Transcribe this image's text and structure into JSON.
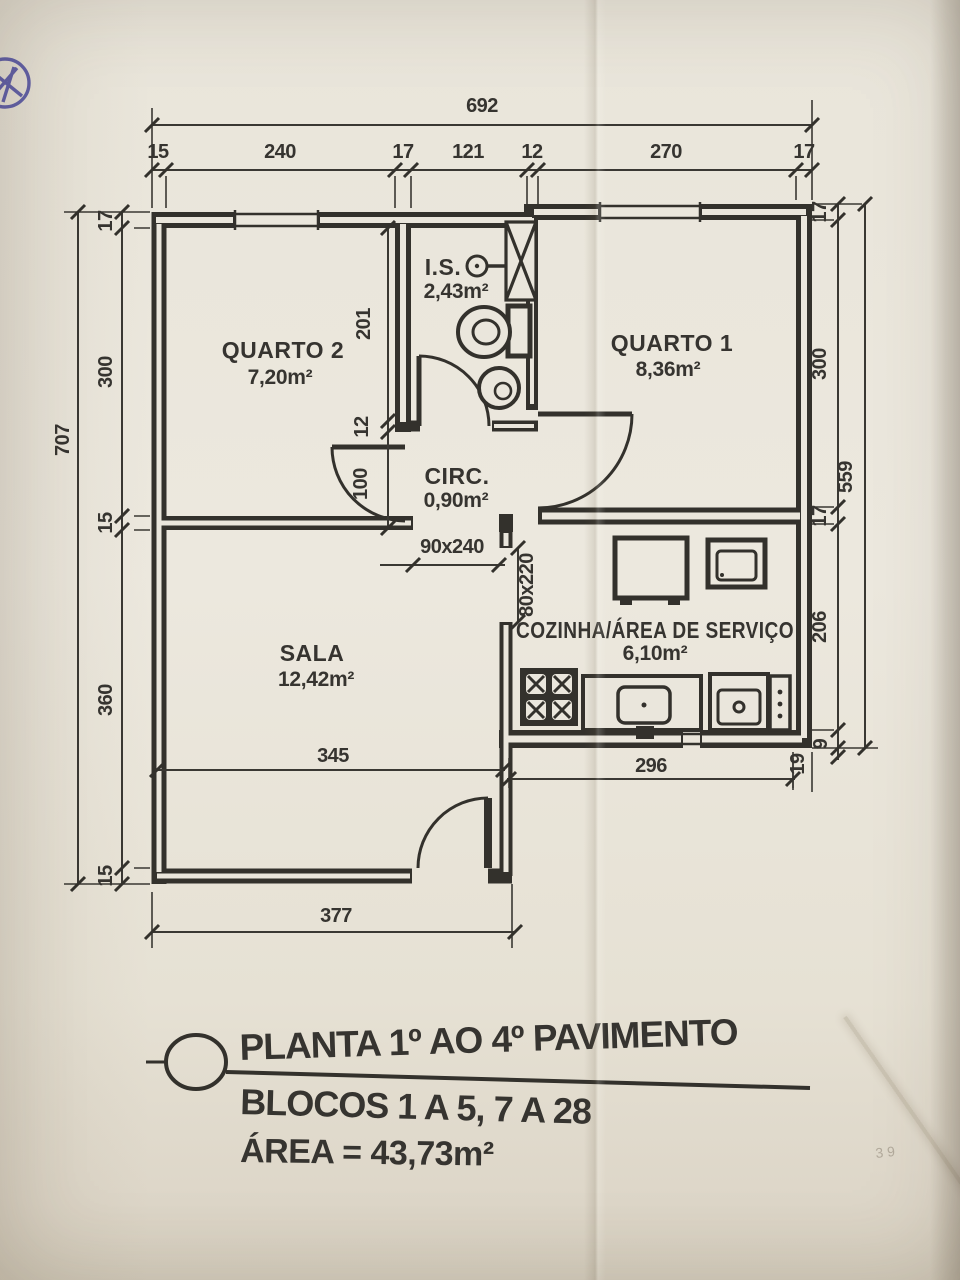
{
  "palette": {
    "paper": "#eae6dc",
    "ink": "#33312c",
    "stamp_blue": "#41419a"
  },
  "rooms": [
    {
      "name": "QUARTO 2",
      "area": "7,20m²"
    },
    {
      "name": "I.S.",
      "area": "2,43m²"
    },
    {
      "name": "QUARTO 1",
      "area": "8,36m²"
    },
    {
      "name": "CIRC.",
      "area": "0,90m²"
    },
    {
      "name": "SALA",
      "area": "12,42m²"
    },
    {
      "name": "COZINHA/ÁREA DE SERVIÇO",
      "area": "6,10m²"
    }
  ],
  "dimensions": {
    "top": {
      "total": "692",
      "segments": [
        "15",
        "240",
        "17",
        "121",
        "12",
        "270",
        "17"
      ]
    },
    "left": {
      "total": "707",
      "segments": [
        "17",
        "300",
        "15",
        "360",
        "15"
      ]
    },
    "right": {
      "total": "559",
      "segments": [
        "17",
        "300",
        "17",
        "206",
        "19"
      ],
      "extra": "9"
    },
    "interior": {
      "is_height": "201",
      "wall": "12",
      "circ_height": "100",
      "circ_opening": "90x240",
      "kitchen_opening": "80x220",
      "sala_width": "345",
      "kitchen_width": "296",
      "bottom": "377"
    }
  },
  "title_block": {
    "line1": "PLANTA 1º AO 4º PAVIMENTO",
    "line2": "BLOCOS 1 A 5, 7 A 28",
    "line3": "ÁREA = 43,73m²"
  },
  "annotations": {
    "faint_note": "3 9"
  }
}
